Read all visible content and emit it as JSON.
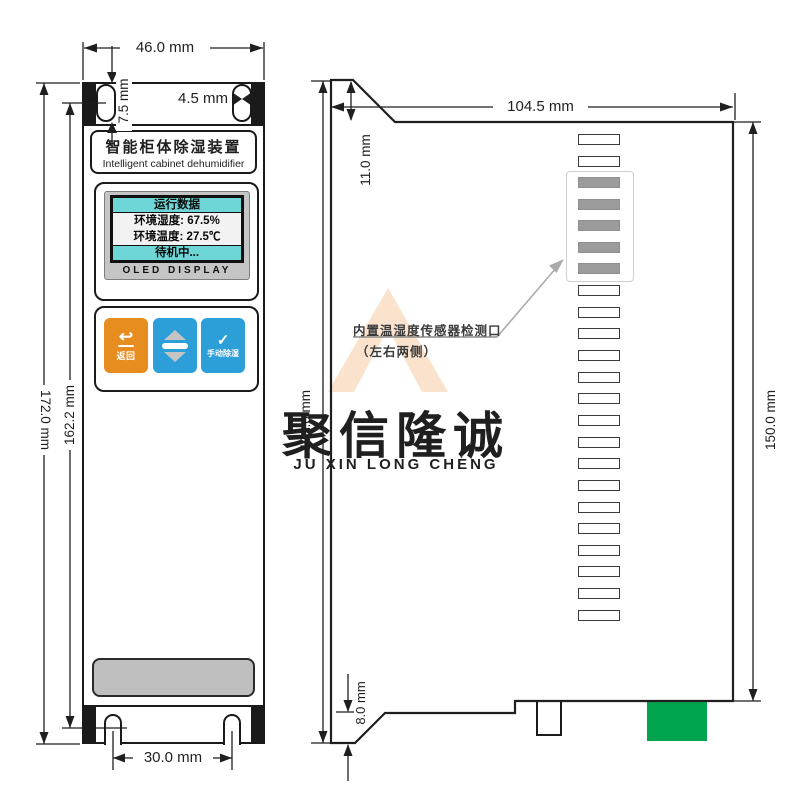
{
  "watermark": {
    "cn": "聚信隆诚",
    "en": "JU XIN LONG CHENG"
  },
  "front_view": {
    "title_cn": "智能柜体除湿装置",
    "title_en": "Intelligent cabinet dehumidifier",
    "display": {
      "row1": "运行数据",
      "row2": "环境湿度: 67.5%",
      "row3": "环境温度: 27.5℃",
      "row4": "待机中...",
      "panel_label": "OLED DISPLAY"
    },
    "buttons": {
      "back_label": "返回",
      "manual_label": "手动除湿"
    },
    "icons": {
      "back_arrow": "↩",
      "check": "✓"
    },
    "dims": {
      "width": "46.0 mm",
      "slot_height": "7.5 mm",
      "slot_width": "4.5 mm",
      "overall_height": "172.0 mm",
      "hole_span": "162.2 mm",
      "notch_span": "30.0 mm"
    }
  },
  "side_view": {
    "dims": {
      "depth": "104.5 mm",
      "top_chamfer": "11.0 mm",
      "overall_height": "172.0 mm",
      "body_height": "150.0 mm",
      "bottom_chamfer": "8.0 mm"
    },
    "callout_line1": "内置温湿度传感器检测口",
    "callout_line2": "（左右两侧）",
    "vent_slots": {
      "above_count": 2,
      "gray_count": 5,
      "below_count": 16
    }
  },
  "colors": {
    "display_cyan": "#6ED6D6",
    "button_orange": "#E78C1E",
    "button_blue": "#2C9FD8",
    "connector_green": "#00A44F",
    "vent_gray": "#BFBFBF",
    "watermark_gray": "#E1E1E1",
    "watermark_gold": "#F2D584"
  }
}
